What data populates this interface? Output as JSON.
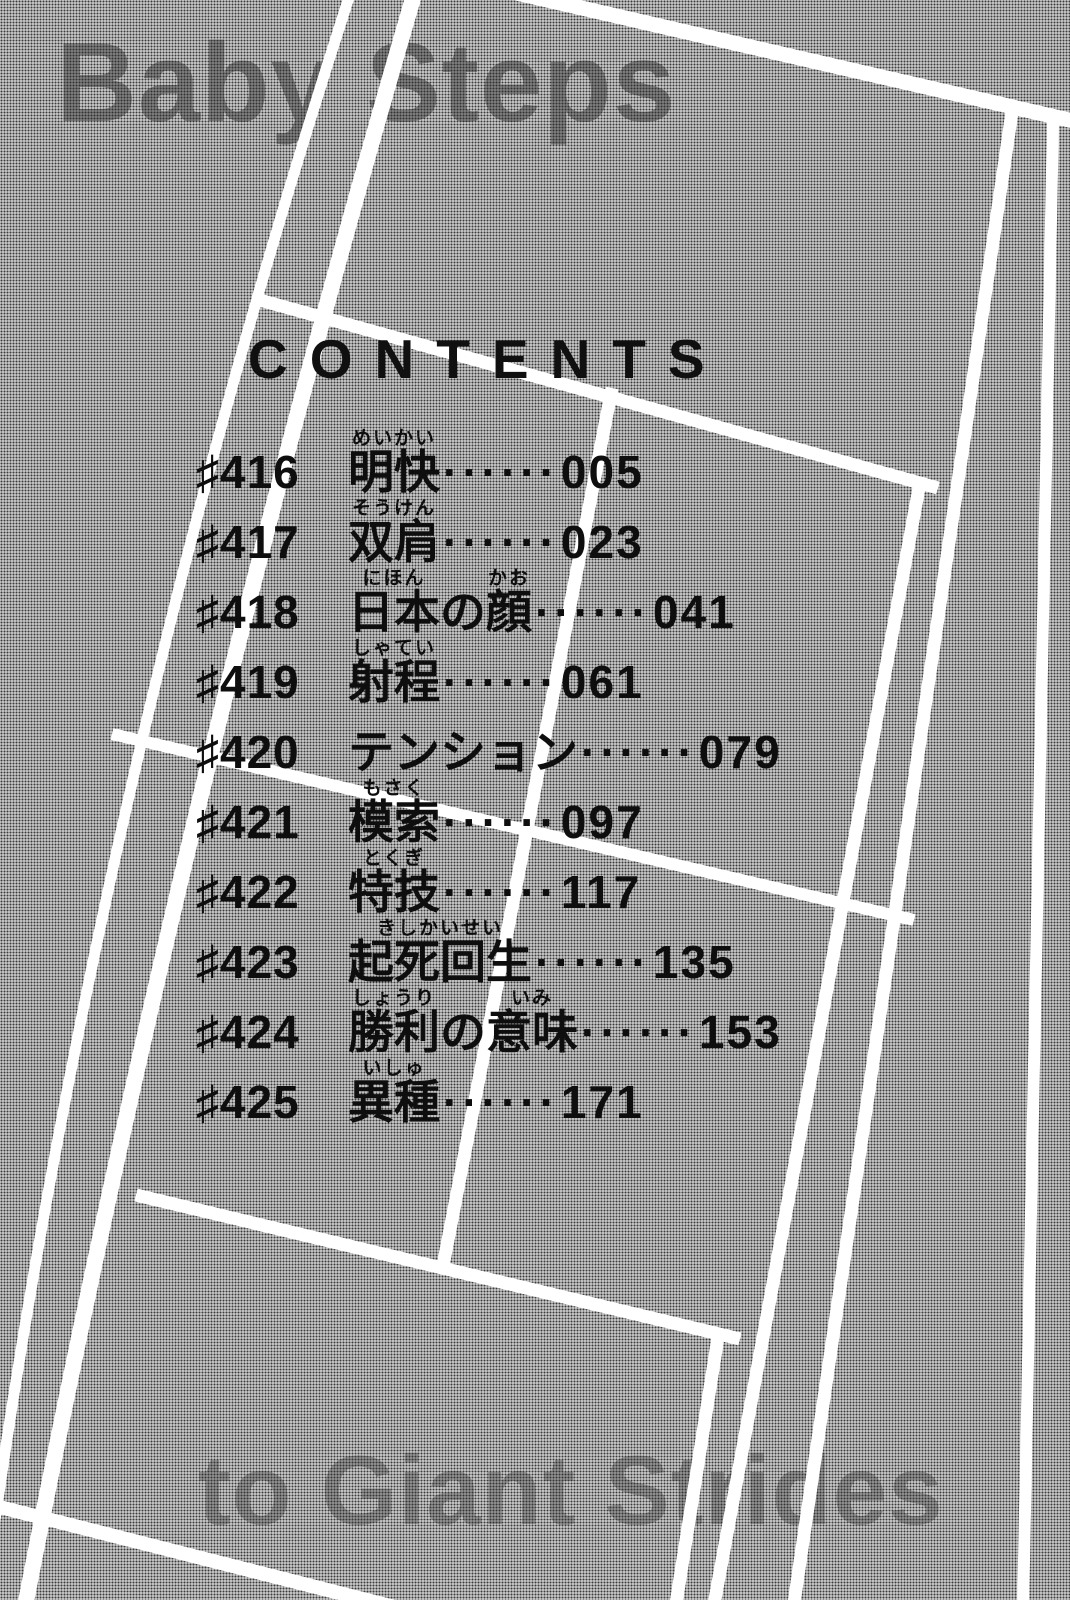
{
  "banners": {
    "top": "Baby Steps",
    "bottom": "to Giant Strides"
  },
  "heading": "CONTENTS",
  "toc": {
    "chapter_prefix": "♯",
    "leader": "······",
    "entries": [
      {
        "number": "416",
        "page": "005",
        "title": [
          {
            "text": "明快",
            "ruby": "めいかい"
          }
        ]
      },
      {
        "number": "417",
        "page": "023",
        "title": [
          {
            "text": "双肩",
            "ruby": "そうけん"
          }
        ]
      },
      {
        "number": "418",
        "page": "041",
        "title": [
          {
            "text": "日本",
            "ruby": "にほん"
          },
          {
            "text": "の",
            "ruby": ""
          },
          {
            "text": "顔",
            "ruby": "かお"
          }
        ]
      },
      {
        "number": "419",
        "page": "061",
        "title": [
          {
            "text": "射程",
            "ruby": "しゃてい"
          }
        ]
      },
      {
        "number": "420",
        "page": "079",
        "title": [
          {
            "text": "テンション",
            "ruby": ""
          }
        ]
      },
      {
        "number": "421",
        "page": "097",
        "title": [
          {
            "text": "模索",
            "ruby": "もさく"
          }
        ]
      },
      {
        "number": "422",
        "page": "117",
        "title": [
          {
            "text": "特技",
            "ruby": "とくぎ"
          }
        ]
      },
      {
        "number": "423",
        "page": "135",
        "title": [
          {
            "text": "起死回生",
            "ruby": "きしかいせい"
          }
        ]
      },
      {
        "number": "424",
        "page": "153",
        "title": [
          {
            "text": "勝利",
            "ruby": "しょうり"
          },
          {
            "text": "の",
            "ruby": ""
          },
          {
            "text": "意味",
            "ruby": "いみ"
          }
        ]
      },
      {
        "number": "425",
        "page": "171",
        "title": [
          {
            "text": "異種",
            "ruby": "いしゅ"
          }
        ]
      }
    ]
  },
  "colors": {
    "background_base": "#d8d8d8",
    "halftone_dot": "#3b3b3b",
    "court_line": "#ffffff",
    "text": "#0e0e0e",
    "faded_banner_text": "#282828"
  }
}
